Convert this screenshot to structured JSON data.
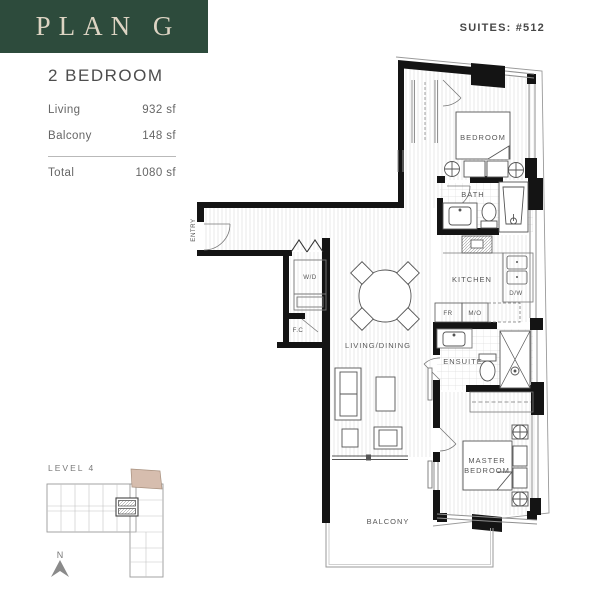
{
  "header": {
    "plan_label": "PLAN G",
    "suites_label": "SUITES: #512"
  },
  "unit": {
    "type_label": "2 BEDROOM",
    "areas": [
      {
        "label": "Living",
        "value": "932 sf"
      },
      {
        "label": "Balcony",
        "value": "148 sf"
      }
    ],
    "total": {
      "label": "Total",
      "value": "1080 sf"
    }
  },
  "floorplan": {
    "rooms": {
      "bedroom": "BEDROOM",
      "bath": "BATH",
      "kitchen": "KITCHEN",
      "ensuite": "ENSUITE",
      "master_line1": "MASTER",
      "master_line2": "BEDROOM",
      "living_dining": "LIVING/DINING",
      "balcony": "BALCONY",
      "entry": "ENTRY"
    },
    "fixtures": {
      "washer_dryer": "W/D",
      "fan_coil": "F.C",
      "fridge": "FR",
      "microwave": "M/O",
      "dishwasher": "D/W"
    }
  },
  "keyplan": {
    "level_label": "LEVEL 4",
    "north_label": "N",
    "highlight_color": "#d6bdae"
  },
  "colors": {
    "header_bg": "#2d4b3c",
    "header_text": "#ddd4c3",
    "wall": "#141414"
  }
}
